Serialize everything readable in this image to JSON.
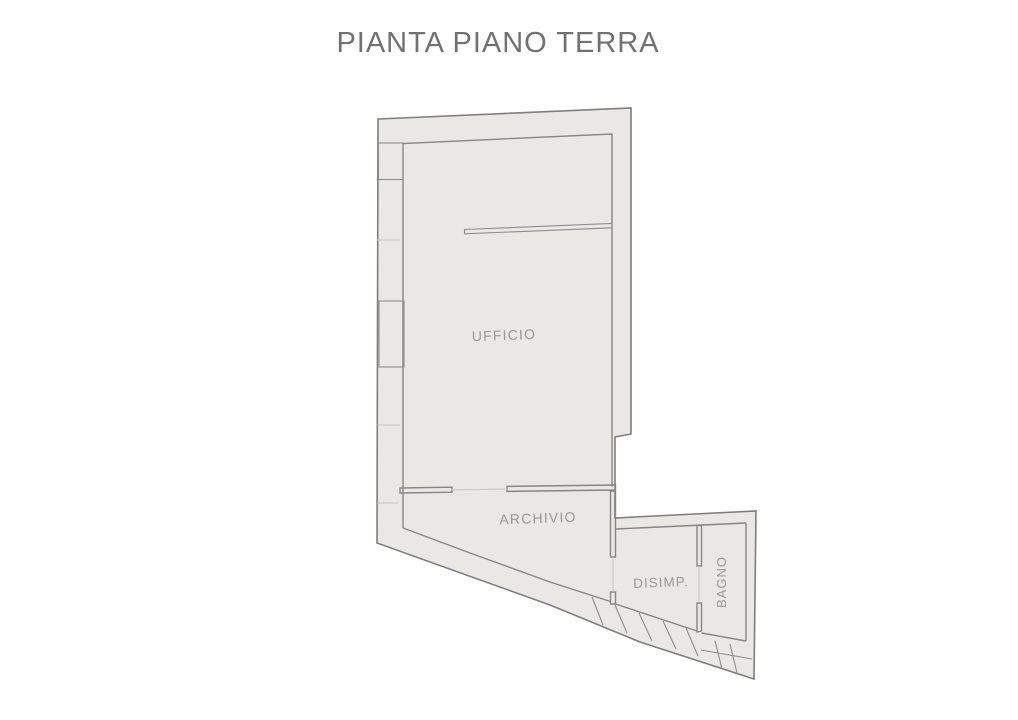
{
  "title": "PIANTA PIANO TERRA",
  "plan": {
    "rooms": [
      {
        "name": "ufficio",
        "label": "UFFICIO"
      },
      {
        "name": "archivio",
        "label": "ARCHIVIO"
      },
      {
        "name": "disimpegno",
        "label": "DISIMP."
      },
      {
        "name": "bagno",
        "label": "BAGNO"
      }
    ]
  },
  "colors": {
    "background": "#ffffff",
    "floor_fill": "#e9e8e5",
    "wall_line": "#868686",
    "outer_line": "#7e7e7e",
    "title_text": "#717171",
    "label_text": "#989898"
  }
}
